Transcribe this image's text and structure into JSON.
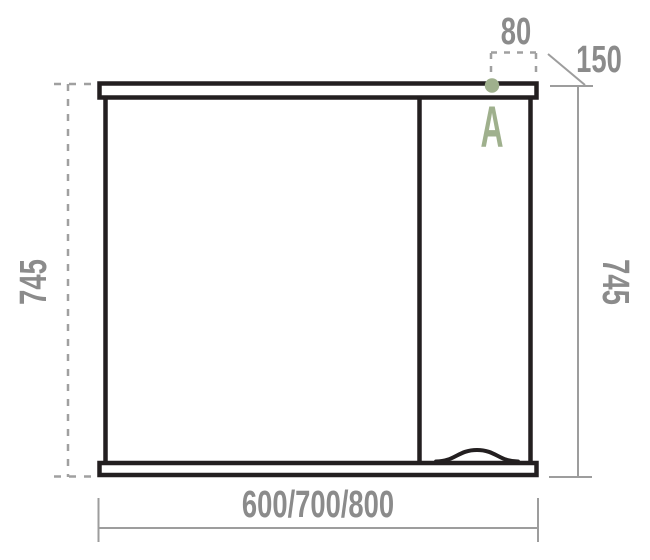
{
  "drawing": {
    "title": "mirror-cabinet-front-view-dimension-drawing",
    "labels": {
      "offset_top": "80",
      "depth_right": "150",
      "height_left": "745",
      "height_right": "745",
      "width_options": "600/700/800",
      "point_marker": "A"
    },
    "colors": {
      "outline_black": "#231f20",
      "dimension_gray": "#9d9d9d",
      "text_gray": "#8b8b8b",
      "accent_green": "#9fb08d",
      "background": "#ffffff"
    }
  }
}
